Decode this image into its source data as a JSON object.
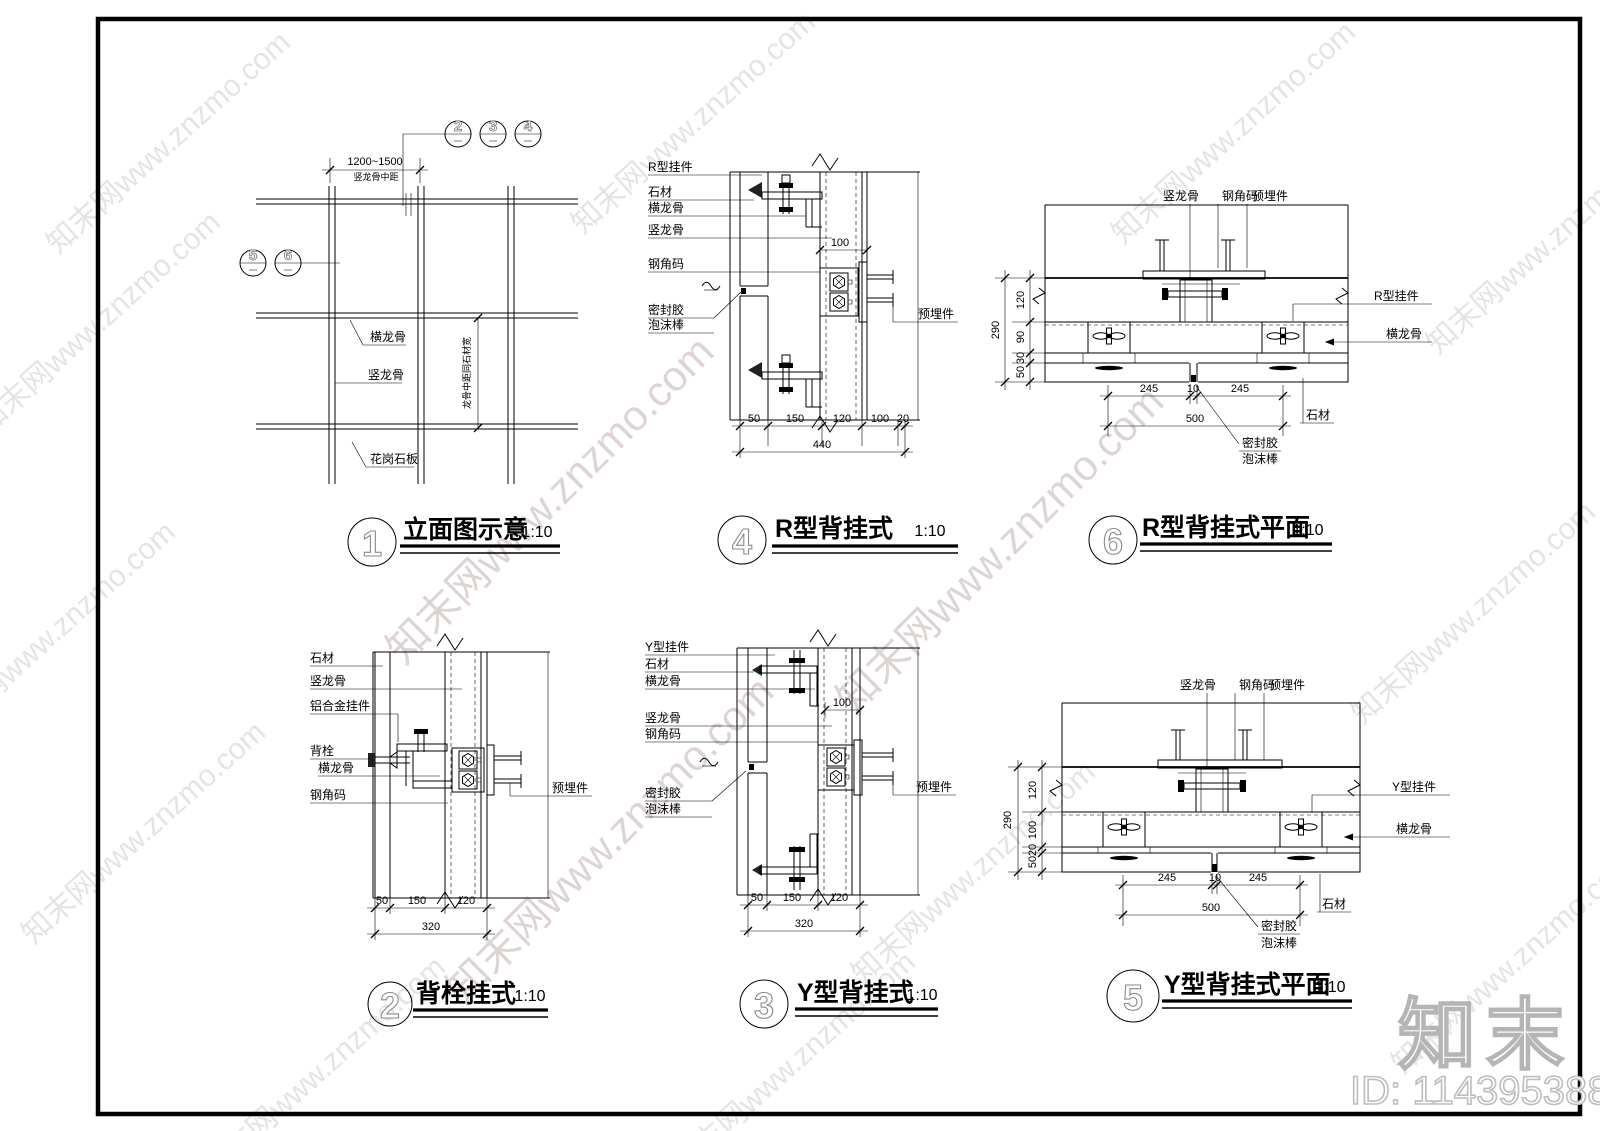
{
  "watermark": {
    "text": "知末网www.znzmo.com",
    "logo": "知末",
    "id_text": "ID: 1143953888"
  },
  "details": {
    "d1": {
      "num": "1",
      "title": "立面图示意",
      "scale": "1:10",
      "callouts_top": [
        "2",
        "3",
        "4"
      ],
      "callouts_left": [
        "5",
        "6"
      ],
      "dim_span": "1200~1500",
      "dim_span_label": "竖龙骨中距",
      "dim_vertical": "龙骨中距同石材宽",
      "label_hlg": "横龙骨",
      "label_vlg": "竖龙骨",
      "label_slab": "花岗石板"
    },
    "d2": {
      "num": "2",
      "title": "背栓挂式",
      "scale": "1:10",
      "labels": [
        "石材",
        "竖龙骨",
        "铝合金挂件",
        "背栓",
        "横龙骨",
        "钢角码"
      ],
      "label_embed": "预埋件",
      "dims": [
        "50",
        "150",
        "120"
      ],
      "dim_total": "320"
    },
    "d3": {
      "num": "3",
      "title": "Y型背挂式",
      "scale": "1:10",
      "labels": [
        "Y型挂件",
        "石材",
        "横龙骨",
        "竖龙骨",
        "钢角码",
        "密封胶",
        "泡沫棒"
      ],
      "label_embed": "预埋件",
      "dim_100": "100",
      "dims": [
        "50",
        "150",
        "120"
      ],
      "dim_total": "320"
    },
    "d4": {
      "num": "4",
      "title": "R型背挂式",
      "scale": "1:10",
      "labels": [
        "R型挂件",
        "石材",
        "横龙骨",
        "竖龙骨",
        "钢角码",
        "密封胶",
        "泡沫棒"
      ],
      "label_embed": "预埋件",
      "dim_100": "100",
      "dims": [
        "50",
        "150",
        "120",
        "100",
        "20"
      ],
      "dim_total": "440"
    },
    "d5": {
      "num": "5",
      "title": "Y型背挂式平面",
      "scale": "1:10",
      "labels_top": [
        "竖龙骨",
        "钢角码",
        "预埋件"
      ],
      "labels_right": [
        "Y型挂件",
        "横龙骨",
        "石材"
      ],
      "labels_joint": [
        "密封胶",
        "泡沫棒"
      ],
      "dims_left": [
        "120",
        "100",
        "20",
        "50"
      ],
      "dim_left_total": "290",
      "dims_bottom": [
        "245",
        "10",
        "245"
      ],
      "dim_bottom_total": "500"
    },
    "d6": {
      "num": "6",
      "title": "R型背挂式平面",
      "scale": "1:10",
      "labels_top": [
        "竖龙骨",
        "钢角码",
        "预埋件"
      ],
      "labels_right": [
        "R型挂件",
        "横龙骨",
        "石材"
      ],
      "labels_joint": [
        "密封胶",
        "泡沫棒"
      ],
      "dims_left": [
        "120",
        "90",
        "30",
        "50"
      ],
      "dim_left_total": "290",
      "dims_bottom": [
        "245",
        "10",
        "245"
      ],
      "dim_bottom_total": "500"
    }
  }
}
